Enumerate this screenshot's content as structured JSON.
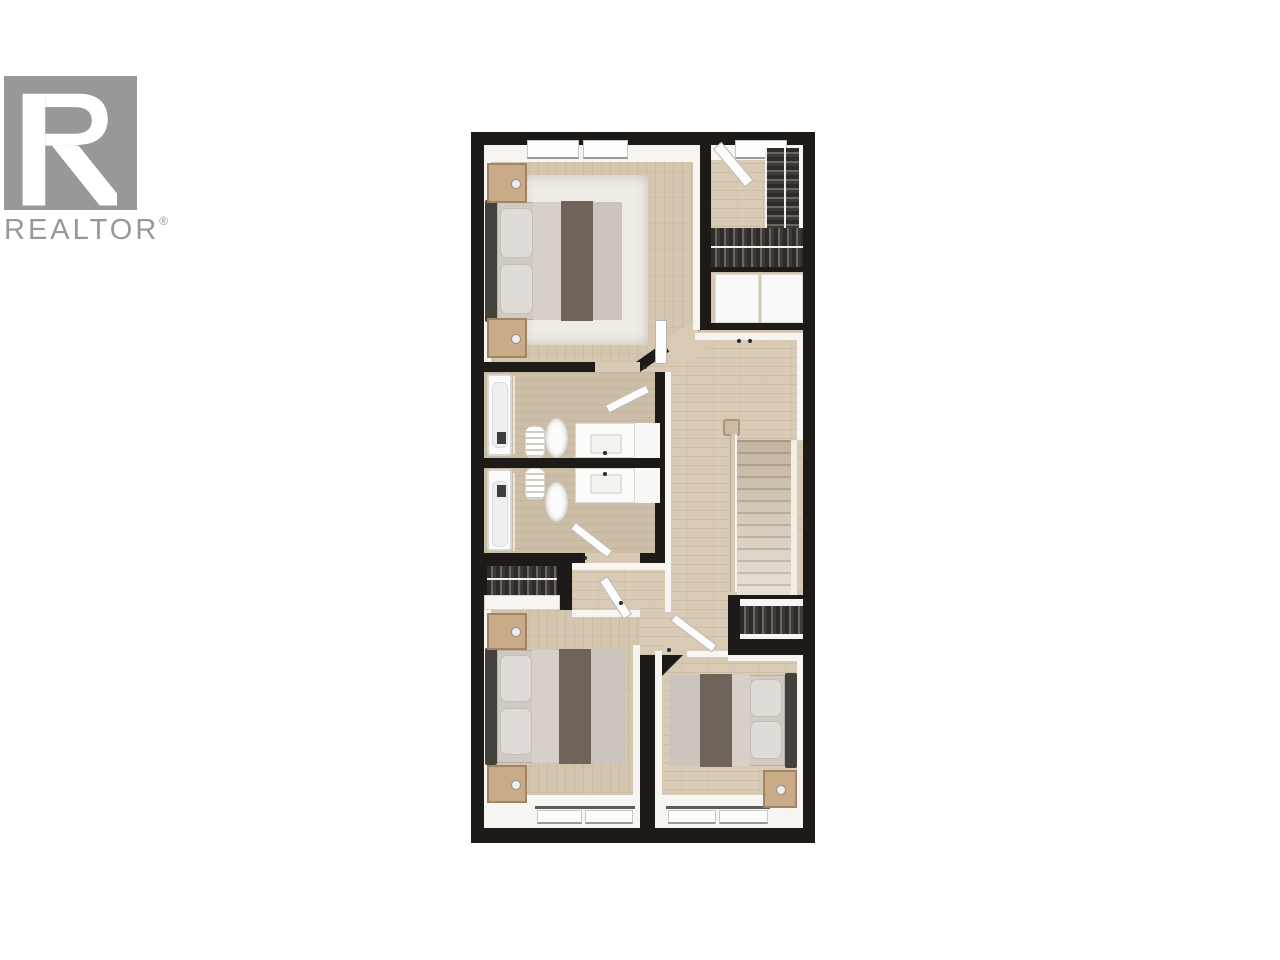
{
  "logo": {
    "brand": "REALTOR",
    "registered": "®"
  },
  "image": {
    "type": "3d-rendered-top-down-floor-plan"
  },
  "floor_plan": {
    "rooms": [
      "master-bedroom",
      "walk-in-closet",
      "laundry-cabinet-room",
      "hallway",
      "staircase",
      "bathroom-upper",
      "bathroom-lower",
      "bedroom-2",
      "bedroom-2-closet",
      "bedroom-3",
      "linen-closet"
    ]
  },
  "colors": {
    "page_bg": "#ffffff",
    "logo_gray": "#98989b",
    "wall": "#1d1a17",
    "floor": "#d5c6af",
    "floor_hall": "#d8cab4",
    "floor_bath": "#ccbda6",
    "rug": "#efece6",
    "wood_furniture": "#c9ab88",
    "bed_stripe": "#6f6459"
  }
}
